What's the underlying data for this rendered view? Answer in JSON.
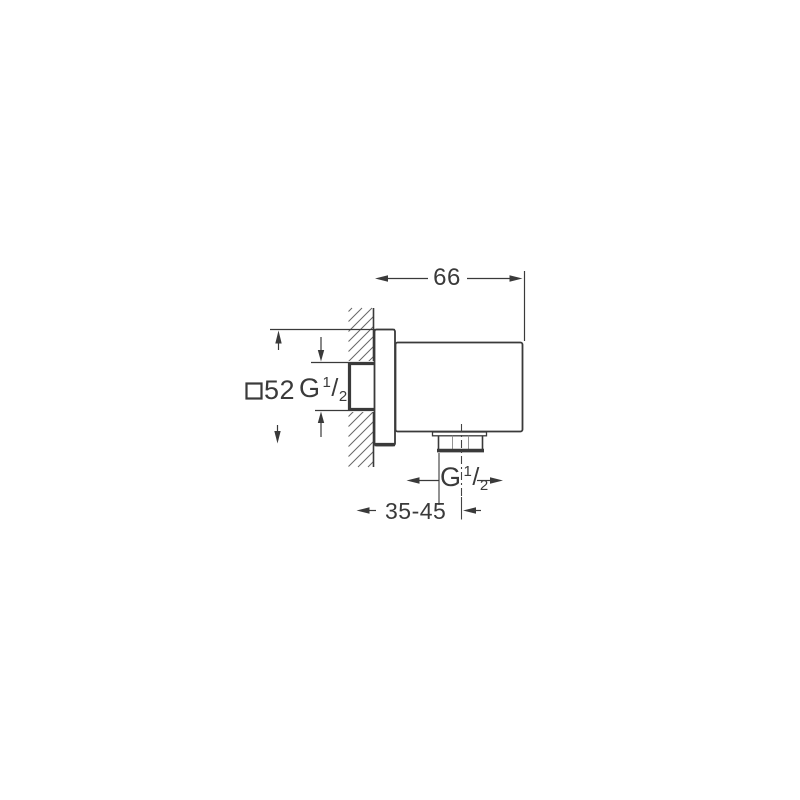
{
  "labels": {
    "top_width": "66",
    "plate_size": "52",
    "depth_range": "35-45",
    "inlet_thread": {
      "g": "G",
      "sup": "1",
      "slash": "/",
      "sub": "2"
    },
    "outlet_thread": {
      "g": "G",
      "sup": "1",
      "slash": "/",
      "sub": "2"
    }
  },
  "icons": {
    "square_symbol": "square-outline (square-section indicator before 52)"
  },
  "colors": {
    "ink": "#3a3a3a",
    "hatch": "#666666",
    "background": "#ffffff"
  }
}
